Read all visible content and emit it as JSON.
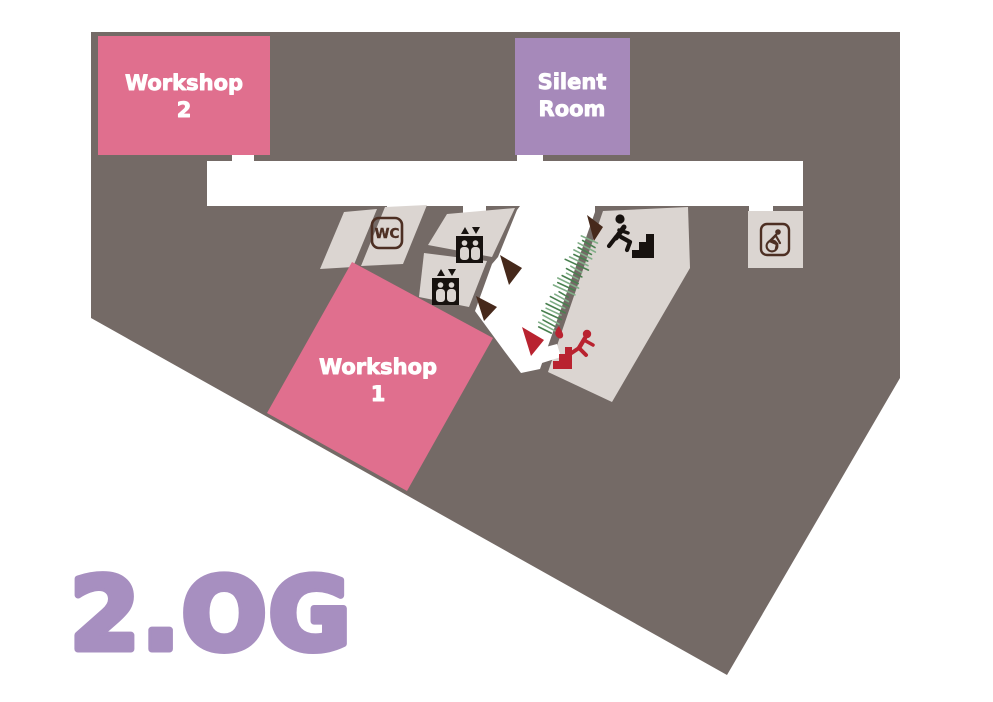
{
  "floor_label": "2.OG",
  "rooms": {
    "workshop2": {
      "line1": "Workshop",
      "line2": "2"
    },
    "silent_room": {
      "line1": "Silent",
      "line2": "Room"
    },
    "workshop1": {
      "line1": "Workshop",
      "line2": "1"
    },
    "wc": {
      "label": "WC"
    }
  },
  "icons": {
    "wc": "wc-sign",
    "accessible_wc": "wheelchair-sign",
    "elevator_upper": "elevator-sign",
    "elevator_lower": "elevator-sign",
    "stairs_up": "person-climbing-stairs",
    "emergency_exit": "person-running-downstairs"
  },
  "colors": {
    "background": "#ffffff",
    "floor_dark": "#746a66",
    "room_gray": "#dbd5d1",
    "workshop_pink": "#e06f8e",
    "silent_purple": "#a689ba",
    "floor_label_purple": "#a78fc0",
    "icon_brown": "#4d2f23",
    "arrow_brown": "#46291b",
    "exit_red": "#b92330",
    "icon_black": "#17120f",
    "hatch_green_light": "#7fae86",
    "hatch_green_dark": "#49804f"
  },
  "green_hatch": {
    "x1": 590,
    "y1": 240,
    "x2": 545,
    "y2": 330,
    "count": 26,
    "half_len": 8
  }
}
